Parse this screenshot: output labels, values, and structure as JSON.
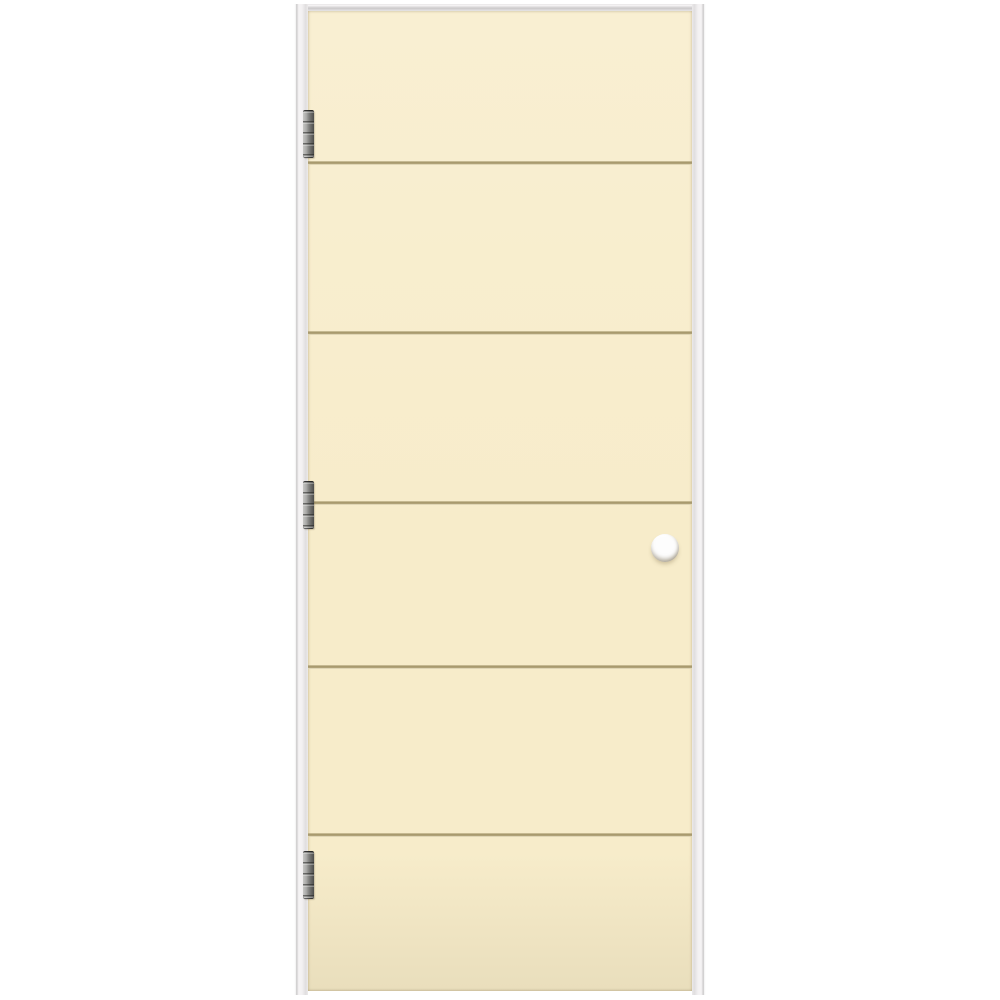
{
  "image": {
    "type": "product-photo",
    "subject": "Pre-hung cream flush interior door with five horizontal grooves, three left-side hinges, a drilled door-knob bore hole, and a white door-frame jamb on a plain white background",
    "background_color": "#ffffff"
  },
  "stage": {
    "width": 1000,
    "height": 1000
  },
  "frame": {
    "left": 294,
    "top": 4,
    "width": 412,
    "bottom": 995,
    "jamb_width": 14,
    "head_height": 8,
    "base_color": "#f2f0f1",
    "edge_color": "#cbc9ca",
    "shade_color": "#e0dedf"
  },
  "door": {
    "left": 308,
    "top": 11,
    "width": 384,
    "height": 980,
    "color_top": "#f9efd2",
    "color_mid": "#f7ecca",
    "color_bottom": "#ece1bf",
    "panel_count": 6,
    "grooves": {
      "count": 5,
      "color": "#a89a6e",
      "highlight_color": "#fcf3d8",
      "y_positions": [
        163,
        333,
        503,
        667,
        835
      ]
    }
  },
  "hinges": {
    "count": 3,
    "x": 303,
    "width": 11,
    "height": 48,
    "y_positions": [
      110,
      481,
      851
    ],
    "color_light": "#c6c6c4",
    "color_mid": "#7e7e7c",
    "color_dark": "#4d4d4b"
  },
  "bore_hole": {
    "cx": 665,
    "cy": 548,
    "radius": 14,
    "fill": "#fdfdfd",
    "rim_shadow": "#9c9384"
  }
}
